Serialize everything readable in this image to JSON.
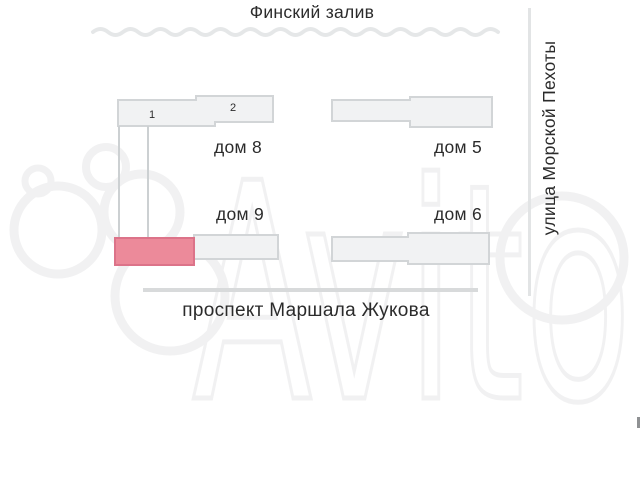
{
  "map": {
    "water_label": "Финский залив",
    "streets": {
      "right": "улица Морской Пехоты",
      "bottom": "проспект Маршала Жукова"
    },
    "houses": [
      {
        "label": "дом 8"
      },
      {
        "label": "дом 5"
      },
      {
        "label": "дом 9"
      },
      {
        "label": "дом 6"
      }
    ],
    "unit_numbers": [
      "1",
      "2"
    ],
    "highlighted_section": {
      "house": "дом 9",
      "fill": "#ec8a9a",
      "stroke": "#dc7389"
    },
    "watermark": "Avito",
    "colors": {
      "building_fill": "#f1f2f3",
      "building_stroke": "#d2d5d7",
      "water_line": "#e5e7e8",
      "road_line": "#d8dadb",
      "text": "#2b2b2b",
      "watermark": "#f0f0f1"
    }
  }
}
